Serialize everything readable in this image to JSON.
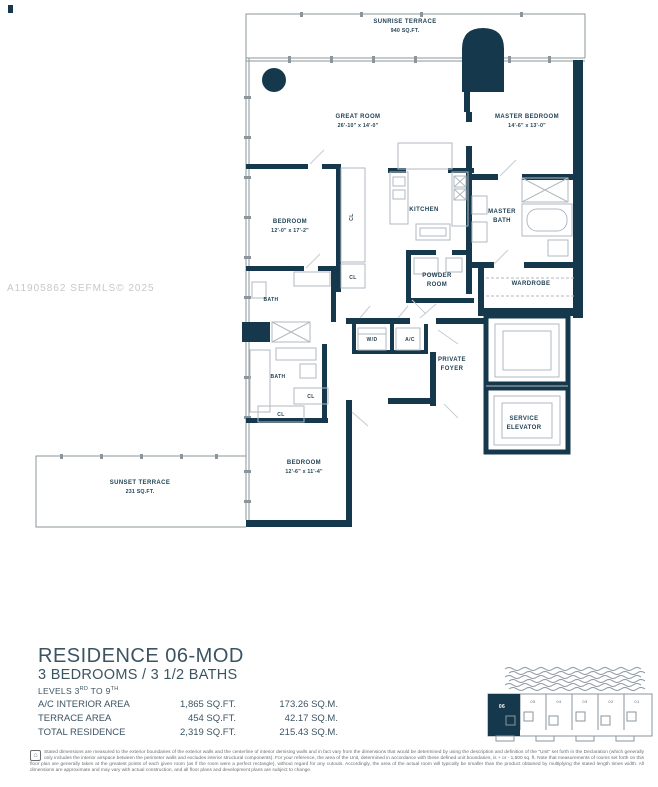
{
  "watermark": "A11905862  SEFMLS© 2025",
  "plan": {
    "sunrise_terrace": {
      "label": "SUNRISE TERRACE",
      "area": "940 SQ.FT."
    },
    "great_room": {
      "label": "GREAT ROOM",
      "dims": "26'-10\" x 14'-0\""
    },
    "master_bedroom": {
      "label": "MASTER BEDROOM",
      "dims": "14'-6\" x 13'-0\""
    },
    "bedroom_2": {
      "label": "BEDROOM",
      "dims": "12'-0\" x 17'-2\""
    },
    "bedroom_3": {
      "label": "BEDROOM",
      "dims": "12'-6\" x 11'-4\""
    },
    "kitchen": "KITCHEN",
    "master_bath": {
      "line1": "MASTER",
      "line2": "BATH"
    },
    "powder_room": {
      "line1": "POWDER",
      "line2": "ROOM"
    },
    "wardrobe": "WARDROBE",
    "bath": "BATH",
    "cl": "CL",
    "wd": "W/D",
    "ac": "A/C",
    "private_foyer": {
      "line1": "PRIVATE",
      "line2": "FOYER"
    },
    "service_elevator": {
      "line1": "SERVICE",
      "line2": "ELEVATOR"
    },
    "sunset_terrace": {
      "label": "SUNSET TERRACE",
      "area": "231 SQ.FT."
    }
  },
  "info": {
    "title": "RESIDENCE 06-MOD",
    "subtitle": "3 BEDROOMS / 3 1/2 BATHS",
    "levels": {
      "p1": "LEVELS 3",
      "s1": "RD",
      "p2": " TO 9",
      "s2": "TH"
    }
  },
  "table": {
    "rows": [
      {
        "label": "A/C INTERIOR AREA",
        "sqft": "1,865 SQ.FT.",
        "sqm": "173.26 SQ.M."
      },
      {
        "label": "TERRACE AREA",
        "sqft": "454 SQ.FT.",
        "sqm": "42.17 SQ.M."
      },
      {
        "label": "TOTAL RESIDENCE",
        "sqft": "2,319 SQ.FT.",
        "sqm": "215.43 SQ.M."
      }
    ]
  },
  "keyplan": {
    "units": [
      "06",
      "05",
      "04",
      "03",
      "02",
      "01"
    ]
  },
  "disclaimer": "Stated dimensions are measured to the exterior boundaries of the exterior walls and the centerline of interior demising walls and in fact vary from the dimensions that would be determined by using the description and definition of the \"Unit\" set forth in the Declaration (which generally only includes the interior airspace between the perimeter walls and excludes interior structural components). For your reference, the area of the Unit, determined in accordance with these defined unit boundaries, is + or - 1,500 sq. ft. Note that measurements of rooms set forth on this floor plan are generally taken at the greatest points of each given room (as if the room were a perfect rectangle), without regard for any cutouts. Accordingly, the area of the actual room will typically be smaller than the product obtained by multiplying the stated length times width. All dimensions are approximate and may vary with actual construction, and all floor plans and development plans are subject to change.",
  "colors": {
    "wall": "#16384c",
    "label": "#1d3f52",
    "watermark": "#c4c9cc",
    "body_text": "#3c5462"
  }
}
